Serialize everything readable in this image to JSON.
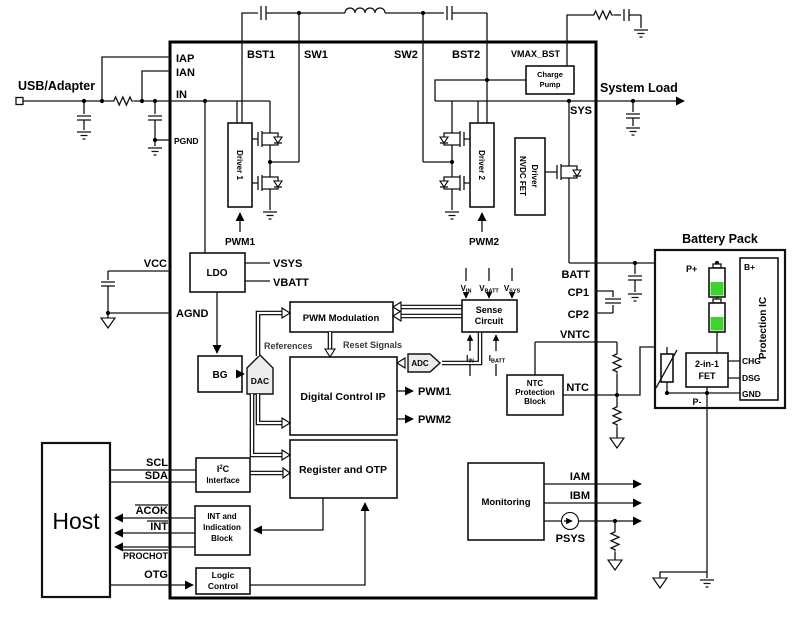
{
  "colors": {
    "line": "#000000",
    "battery_green": "#3ed42c",
    "shape_fill": "#ececec"
  },
  "labels": {
    "usb": "USB/Adapter",
    "system_load": "System Load",
    "host": "Host",
    "battery_pack": "Battery Pack",
    "iap": "IAP",
    "ian": "IAN",
    "in_pin": "IN",
    "pgnd": "PGND",
    "bst1": "BST1",
    "sw1": "SW1",
    "sw2": "SW2",
    "bst2": "BST2",
    "vmax_bst": "VMAX_BST",
    "sys": "SYS",
    "charge_pump_1": "Charge",
    "charge_pump_2": "Pump",
    "driver1": "Driver 1",
    "driver2": "Driver 2",
    "nvdc_1": "NVDC FET",
    "nvdc_2": "Driver",
    "pwm1": "PWM1",
    "pwm2": "PWM2",
    "vcc": "VCC",
    "agnd": "AGND",
    "ldo": "LDO",
    "vsys": "VSYS",
    "vbatt": "VBATT",
    "bg": "BG",
    "dac": "DAC",
    "adc": "ADC",
    "pwm_modulation": "PWM Modulation",
    "references": "References",
    "reset_signals": "Reset Signals",
    "digital_control_ip": "Digital Control IP",
    "register_and_otp": "Register and OTP",
    "sense_1": "Sense",
    "sense_2": "Circuit",
    "v_base": "V",
    "i_base": "I",
    "sub_in": "IN",
    "sub_batt": "BATT",
    "sub_sys": "SYS",
    "batt": "BATT",
    "cp1": "CP1",
    "cp2": "CP2",
    "vntc": "VNTC",
    "ntc": "NTC",
    "ntc_block_1": "NTC",
    "ntc_block_2": "Protection",
    "ntc_block_3": "Block",
    "monitoring": "Monitoring",
    "iam": "IAM",
    "ibm": "IBM",
    "psys": "PSYS",
    "scl": "SCL",
    "sda": "SDA",
    "acok": "ACOK",
    "int_sig": "INT",
    "prochot": "PROCHOT",
    "otg": "OTG",
    "i2c_i": "I",
    "i2c_2": "2",
    "i2c_c": "C",
    "i2c_line2": "Interface",
    "int_block_1": "INT and",
    "int_block_2": "Indication",
    "int_block_3": "Block",
    "logic_1": "Logic",
    "logic_2": "Control",
    "p_plus": "P+",
    "p_minus": "P-",
    "b_plus": "B+",
    "protection_ic": "Protection IC",
    "fet_1": "2-in-1",
    "fet_2": "FET",
    "chg": "CHG",
    "dsg": "DSG",
    "gnd": "GND"
  }
}
